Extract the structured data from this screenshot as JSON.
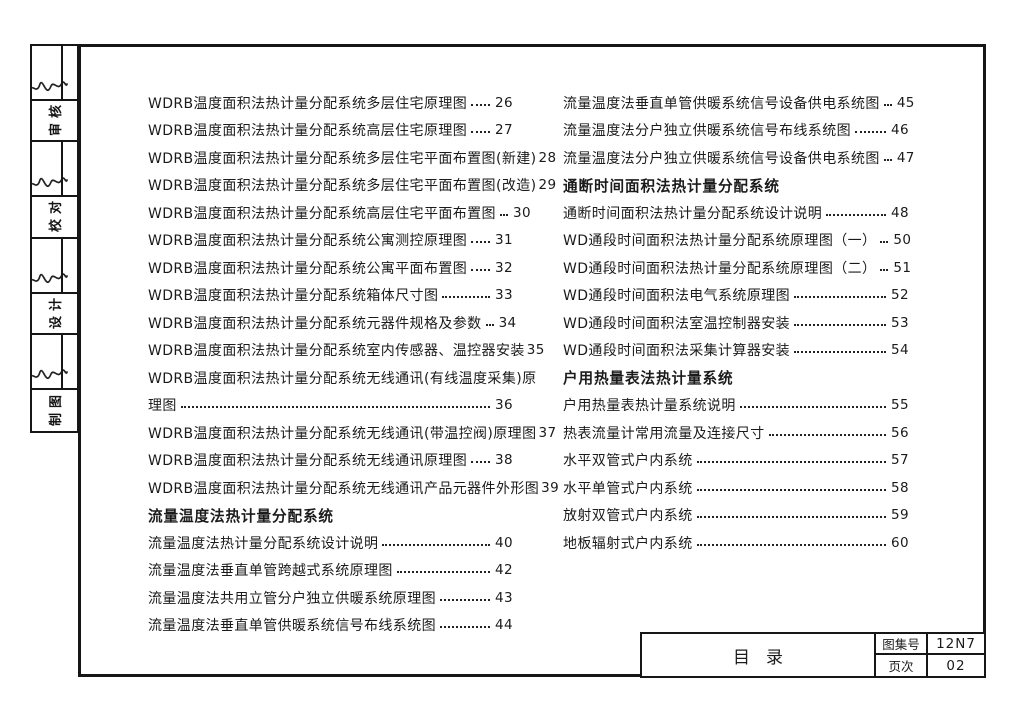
{
  "sidebar": {
    "cells": [
      {
        "type": "signature"
      },
      {
        "type": "label",
        "text": "审核"
      },
      {
        "type": "signature"
      },
      {
        "type": "label",
        "text": "校对"
      },
      {
        "type": "signature"
      },
      {
        "type": "label",
        "text": "设计"
      },
      {
        "type": "signature"
      },
      {
        "type": "label",
        "text": "制图"
      }
    ]
  },
  "toc": {
    "left_column": [
      {
        "text": "WDRB温度面积法热计量分配系统多层住宅原理图",
        "dots": true,
        "page": "26"
      },
      {
        "text": "WDRB温度面积法热计量分配系统高层住宅原理图",
        "dots": true,
        "page": "27"
      },
      {
        "text": "WDRB温度面积法热计量分配系统多层住宅平面布置图(新建)",
        "dots": false,
        "page": "28"
      },
      {
        "text": "WDRB温度面积法热计量分配系统多层住宅平面布置图(改造)",
        "dots": false,
        "page": "29"
      },
      {
        "text": "WDRB温度面积法热计量分配系统高层住宅平面布置图",
        "dots": true,
        "page": "30"
      },
      {
        "text": "WDRB温度面积法热计量分配系统公寓测控原理图",
        "dots": true,
        "page": "31"
      },
      {
        "text": "WDRB温度面积法热计量分配系统公寓平面布置图",
        "dots": true,
        "page": "32"
      },
      {
        "text": "WDRB温度面积法热计量分配系统箱体尺寸图",
        "dots": true,
        "page": "33"
      },
      {
        "text": "WDRB温度面积法热计量分配系统元器件规格及参数",
        "dots": true,
        "page": "34"
      },
      {
        "text": "WDRB温度面积法热计量分配系统室内传感器、温控器安装",
        "dots": false,
        "page": "35"
      },
      {
        "text": "WDRB温度面积法热计量分配系统无线通讯(有线温度采集)原",
        "dots": false,
        "page": null
      },
      {
        "text": "理图",
        "dots": true,
        "page": "36"
      },
      {
        "text": "WDRB温度面积法热计量分配系统无线通讯(带温控阀)原理图",
        "dots": false,
        "page": "37"
      },
      {
        "text": "WDRB温度面积法热计量分配系统无线通讯原理图",
        "dots": true,
        "page": "38"
      },
      {
        "text": "WDRB温度面积法热计量分配系统无线通讯产品元器件外形图",
        "dots": false,
        "page": "39"
      },
      {
        "text": "流量温度法热计量分配系统",
        "header": true
      },
      {
        "text": "流量温度法热计量分配系统设计说明",
        "dots": true,
        "page": "40"
      },
      {
        "text": "流量温度法垂直单管跨越式系统原理图",
        "dots": true,
        "page": "42"
      },
      {
        "text": "流量温度法共用立管分户独立供暖系统原理图",
        "dots": true,
        "page": "43"
      },
      {
        "text": "流量温度法垂直单管供暖系统信号布线系统图",
        "dots": true,
        "page": "44"
      }
    ],
    "right_column": [
      {
        "text": "流量温度法垂直单管供暖系统信号设备供电系统图",
        "dots": true,
        "page": "45"
      },
      {
        "text": "流量温度法分户独立供暖系统信号布线系统图",
        "dots": true,
        "page": "46"
      },
      {
        "text": "流量温度法分户独立供暖系统信号设备供电系统图",
        "dots": true,
        "page": "47"
      },
      {
        "text": "通断时间面积法热计量分配系统",
        "header": true
      },
      {
        "text": "通断时间面积法热计量分配系统设计说明",
        "dots": true,
        "page": "48"
      },
      {
        "text": "WD通段时间面积法热计量分配系统原理图（一）",
        "dots": true,
        "page": "50"
      },
      {
        "text": "WD通段时间面积法热计量分配系统原理图（二）",
        "dots": true,
        "page": "51"
      },
      {
        "text": "WD通段时间面积法电气系统原理图",
        "dots": true,
        "page": "52"
      },
      {
        "text": "WD通段时间面积法室温控制器安装",
        "dots": true,
        "page": "53"
      },
      {
        "text": "WD通段时间面积法采集计算器安装",
        "dots": true,
        "page": "54"
      },
      {
        "text": "户用热量表法热计量系统",
        "header": true
      },
      {
        "text": "户用热量表热计量系统说明",
        "dots": true,
        "page": "55"
      },
      {
        "text": "热表流量计常用流量及连接尺寸",
        "dots": true,
        "page": "56"
      },
      {
        "text": "水平双管式户内系统",
        "dots": true,
        "page": "57"
      },
      {
        "text": "水平单管式户内系统",
        "dots": true,
        "page": "58"
      },
      {
        "text": "放射双管式户内系统",
        "dots": true,
        "page": "59"
      },
      {
        "text": "地板辐射式户内系统",
        "dots": true,
        "page": "60"
      }
    ]
  },
  "title_block": {
    "title": "目录",
    "fields": [
      {
        "label": "图集号",
        "value": "12N7"
      },
      {
        "label": "页次",
        "value": "02"
      }
    ]
  },
  "colors": {
    "ink": "#1b1b1b",
    "border": "#161616",
    "paper": "#ffffff"
  }
}
